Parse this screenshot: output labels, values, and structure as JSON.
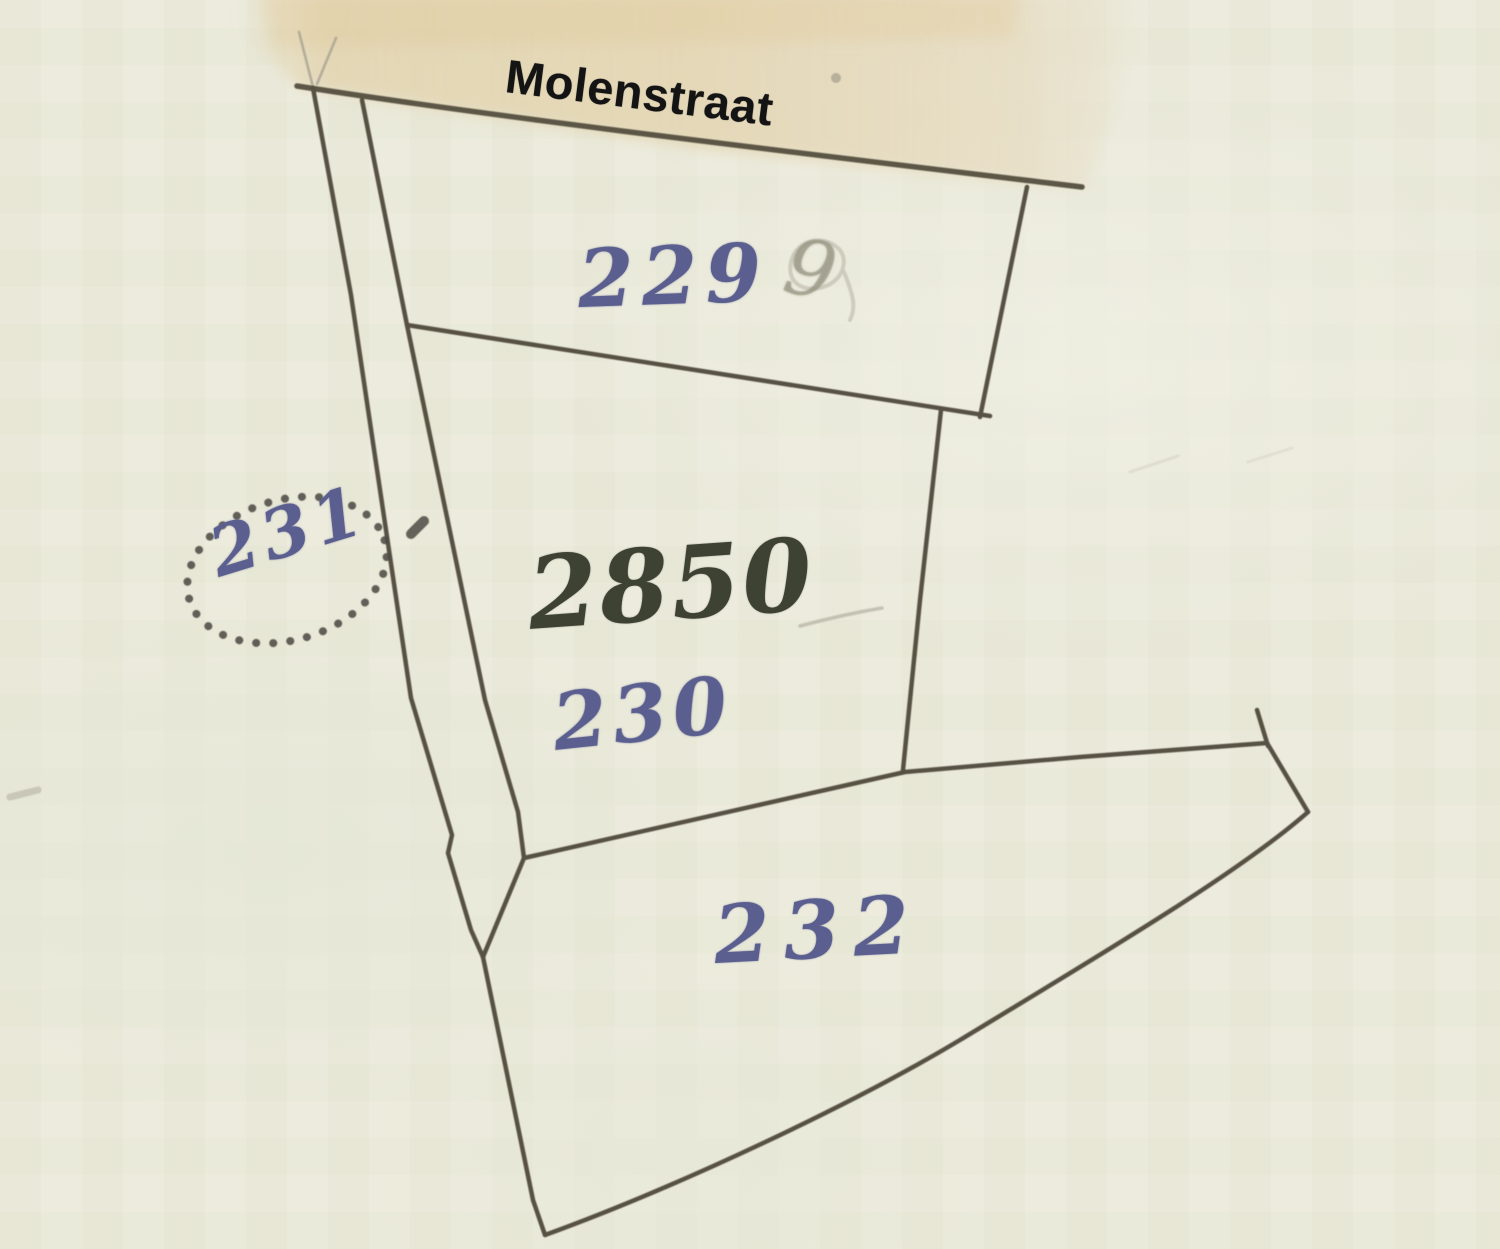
{
  "map": {
    "type": "cadastral-map-scan",
    "street_label": "Molenstraat",
    "parcels": [
      {
        "id": "229",
        "label": "229",
        "ink": "blue"
      },
      {
        "id": "2850",
        "label": "2850",
        "ink": "dark-olive"
      },
      {
        "id": "230",
        "label": "230",
        "ink": "blue"
      },
      {
        "id": "231",
        "label": "231",
        "ink": "blue",
        "circled": "dotted-ellipse"
      },
      {
        "id": "232",
        "label": "232",
        "ink": "blue"
      }
    ],
    "pencil_digit": "9",
    "colors": {
      "paper": "#ecebdb",
      "street_band": "#e5d8ba",
      "boundary_ink": "#50483a",
      "blue_label": "#5b5f8f",
      "dark_label": "#3e4233",
      "pencil": "#aba797",
      "street_text": "#141414"
    }
  }
}
